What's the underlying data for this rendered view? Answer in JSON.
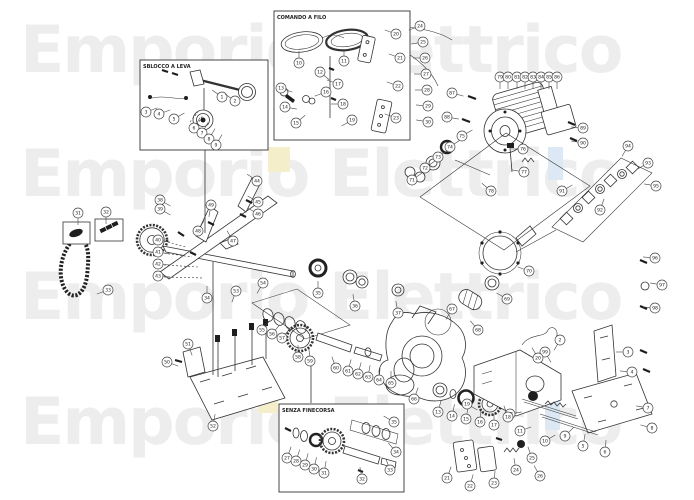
{
  "watermark": {
    "text": "Emporio Elettrico",
    "color": "#ededed",
    "rows": [
      {
        "y": 18
      },
      {
        "y": 142
      },
      {
        "y": 265
      },
      {
        "y": 390
      }
    ],
    "accents": [
      {
        "x": 268,
        "y": 147,
        "w": 22,
        "h": 25,
        "color": "#f5eecb"
      },
      {
        "x": 548,
        "y": 147,
        "w": 15,
        "h": 33,
        "color": "#dce9f4"
      },
      {
        "x": 258,
        "y": 394,
        "w": 20,
        "h": 19,
        "color": "#f5eecb"
      },
      {
        "x": 545,
        "y": 399,
        "w": 15,
        "h": 31,
        "color": "#dce9f4"
      }
    ]
  },
  "insets": [
    {
      "id": "sblocco",
      "label": "SBLOCCO A LEVA"
    },
    {
      "id": "comando",
      "label": "COMANDO A FILO"
    },
    {
      "id": "finecorsa",
      "label": "SENZA FINECORSA"
    }
  ],
  "callouts": [
    [
      1,
      222,
      97,
      215
    ],
    [
      2,
      235,
      101,
      215
    ],
    [
      3,
      146,
      112,
      -20
    ],
    [
      4,
      159,
      114,
      -20
    ],
    [
      5,
      174,
      119,
      -30
    ],
    [
      6,
      194,
      128,
      -60
    ],
    [
      7,
      202,
      133,
      -60
    ],
    [
      8,
      209,
      139,
      -60
    ],
    [
      9,
      216,
      145,
      -60
    ],
    [
      10,
      299,
      63,
      -90
    ],
    [
      11,
      344,
      61,
      -90
    ],
    [
      12,
      320,
      72,
      40
    ],
    [
      13,
      281,
      88,
      20
    ],
    [
      14,
      285,
      107,
      10
    ],
    [
      15,
      296,
      123,
      -40
    ],
    [
      16,
      326,
      92,
      160
    ],
    [
      17,
      338,
      84,
      200
    ],
    [
      18,
      343,
      104,
      180
    ],
    [
      19,
      352,
      120,
      150
    ],
    [
      20,
      396,
      34,
      200
    ],
    [
      21,
      400,
      58,
      200
    ],
    [
      22,
      398,
      86,
      200
    ],
    [
      23,
      396,
      118,
      200
    ],
    [
      24,
      420,
      26,
      160
    ],
    [
      25,
      423,
      42,
      170
    ],
    [
      26,
      425,
      58,
      180
    ],
    [
      27,
      426,
      74,
      180
    ],
    [
      28,
      427,
      90,
      180
    ],
    [
      29,
      428,
      106,
      185
    ],
    [
      30,
      428,
      122,
      190
    ],
    [
      31,
      78,
      213,
      90
    ],
    [
      32,
      106,
      212,
      90
    ],
    [
      33,
      108,
      290,
      160
    ],
    [
      34,
      207,
      298,
      -90
    ],
    [
      35,
      318,
      293,
      -90
    ],
    [
      36,
      355,
      306,
      -100
    ],
    [
      37,
      398,
      313,
      -100
    ],
    [
      38,
      160,
      200,
      30
    ],
    [
      39,
      160,
      209,
      30
    ],
    [
      40,
      158,
      240,
      10
    ],
    [
      41,
      158,
      252,
      10
    ],
    [
      42,
      158,
      264,
      5
    ],
    [
      43,
      158,
      276,
      5
    ],
    [
      44,
      257,
      181,
      215
    ],
    [
      45,
      258,
      202,
      210
    ],
    [
      46,
      258,
      214,
      210
    ],
    [
      47,
      233,
      241,
      -120
    ],
    [
      48,
      198,
      231,
      -60
    ],
    [
      49,
      211,
      205,
      100
    ],
    [
      50,
      167,
      362,
      20
    ],
    [
      51,
      188,
      344,
      70
    ],
    [
      52,
      213,
      426,
      -80
    ],
    [
      53,
      236,
      291,
      110
    ],
    [
      54,
      263,
      283,
      120
    ],
    [
      55,
      262,
      330,
      -50
    ],
    [
      56,
      272,
      334,
      -50
    ],
    [
      57,
      282,
      338,
      -50
    ],
    [
      58,
      298,
      357,
      -90
    ],
    [
      59,
      310,
      361,
      -95
    ],
    [
      60,
      336,
      368,
      -110
    ],
    [
      61,
      348,
      371,
      -75
    ],
    [
      62,
      358,
      374,
      -75
    ],
    [
      63,
      368,
      377,
      -80
    ],
    [
      64,
      379,
      380,
      -85
    ],
    [
      65,
      391,
      383,
      -90
    ],
    [
      66,
      414,
      399,
      -70
    ],
    [
      67,
      452,
      309,
      120
    ],
    [
      68,
      478,
      330,
      -130
    ],
    [
      69,
      507,
      299,
      -150
    ],
    [
      70,
      529,
      271,
      -160
    ],
    [
      71,
      412,
      180,
      -35
    ],
    [
      72,
      425,
      168,
      -35
    ],
    [
      73,
      438,
      157,
      -35
    ],
    [
      74,
      450,
      147,
      -35
    ],
    [
      75,
      462,
      136,
      -30
    ],
    [
      76,
      523,
      149,
      180
    ],
    [
      77,
      524,
      172,
      190
    ],
    [
      78,
      491,
      191,
      -140
    ],
    [
      79,
      500,
      77,
      90
    ],
    [
      80,
      508,
      77,
      90
    ],
    [
      81,
      517,
      77,
      90
    ],
    [
      82,
      525,
      77,
      90
    ],
    [
      83,
      533,
      77,
      90
    ],
    [
      84,
      541,
      77,
      90
    ],
    [
      85,
      549,
      77,
      90
    ],
    [
      86,
      557,
      77,
      90
    ],
    [
      87,
      452,
      93,
      15
    ],
    [
      88,
      447,
      117,
      10
    ],
    [
      89,
      583,
      128,
      185
    ],
    [
      90,
      583,
      143,
      190
    ],
    [
      91,
      562,
      191,
      -30
    ],
    [
      92,
      600,
      210,
      -70
    ],
    [
      93,
      648,
      163,
      150
    ],
    [
      94,
      628,
      146,
      120
    ],
    [
      95,
      656,
      186,
      190
    ],
    [
      96,
      655,
      258,
      185
    ],
    [
      97,
      662,
      285,
      190
    ],
    [
      98,
      655,
      308,
      185
    ],
    [
      99,
      545,
      352,
      60
    ],
    [
      2,
      560,
      340,
      120
    ],
    [
      3,
      628,
      352,
      180
    ],
    [
      4,
      632,
      372,
      185
    ],
    [
      5,
      583,
      446,
      -80
    ],
    [
      6,
      605,
      452,
      -85
    ],
    [
      7,
      648,
      408,
      190
    ],
    [
      8,
      652,
      428,
      195
    ],
    [
      9,
      565,
      436,
      -45
    ],
    [
      10,
      545,
      441,
      -30
    ],
    [
      11,
      520,
      431,
      -20
    ],
    [
      12,
      510,
      414,
      -10
    ],
    [
      13,
      438,
      412,
      -75
    ],
    [
      14,
      452,
      416,
      -78
    ],
    [
      15,
      466,
      419,
      -80
    ],
    [
      16,
      480,
      422,
      -85
    ],
    [
      17,
      494,
      425,
      -90
    ],
    [
      18,
      508,
      417,
      -110
    ],
    [
      19,
      467,
      404,
      30
    ],
    [
      20,
      538,
      358,
      -120
    ],
    [
      21,
      447,
      478,
      -70
    ],
    [
      22,
      470,
      486,
      -75
    ],
    [
      23,
      494,
      483,
      -85
    ],
    [
      24,
      516,
      470,
      -100
    ],
    [
      25,
      532,
      458,
      -110
    ],
    [
      26,
      540,
      476,
      -120
    ],
    [
      27,
      287,
      458,
      -70
    ],
    [
      28,
      296,
      461,
      -72
    ],
    [
      29,
      305,
      465,
      -75
    ],
    [
      30,
      314,
      469,
      -78
    ],
    [
      31,
      324,
      473,
      -80
    ],
    [
      32,
      362,
      479,
      -100
    ],
    [
      33,
      390,
      470,
      -110
    ],
    [
      34,
      396,
      452,
      -130
    ],
    [
      35,
      394,
      422,
      -150
    ]
  ]
}
